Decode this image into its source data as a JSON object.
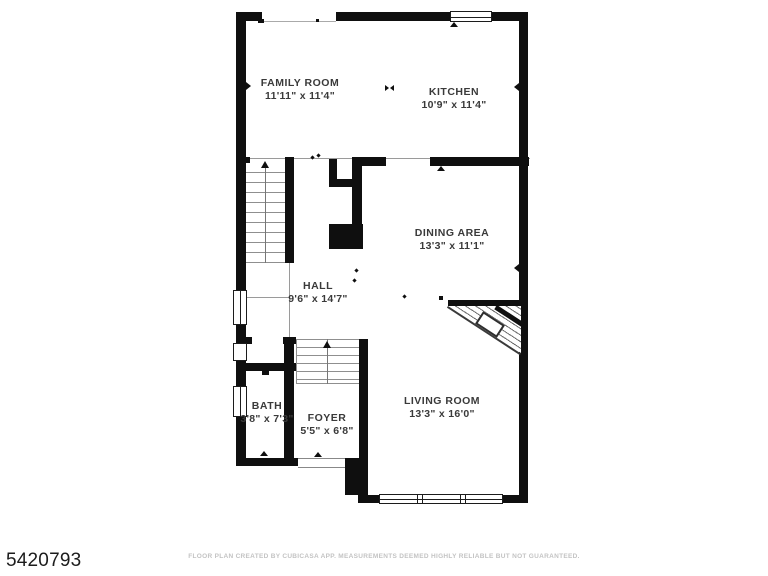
{
  "page": {
    "type": "real-estate floor plan"
  },
  "floor_plan": {
    "rooms": [
      {
        "id": "family-room",
        "name": "FAMILY ROOM",
        "dimensions": "11'11\" x 11'4\""
      },
      {
        "id": "kitchen",
        "name": "KITCHEN",
        "dimensions": "10'9\" x 11'4\""
      },
      {
        "id": "dining-area",
        "name": "DINING AREA",
        "dimensions": "13'3\" x 11'1\""
      },
      {
        "id": "hall",
        "name": "HALL",
        "dimensions": "9'6\" x 14'7\""
      },
      {
        "id": "bath",
        "name": "BATH",
        "dimensions": "3'8\" x 7'3\""
      },
      {
        "id": "foyer",
        "name": "FOYER",
        "dimensions": "5'5\" x 6'8\""
      },
      {
        "id": "living-room",
        "name": "LIVING ROOM",
        "dimensions": "13'3\" x 16'0\""
      }
    ],
    "colors": {
      "wall": "#0f0f0f",
      "thin_line": "#9a9a9a",
      "label_text": "#3a3a3a",
      "id_text": "#1c1c1c",
      "disclaimer_text": "#c3c3c3"
    }
  },
  "footer": {
    "listing_id": "5420793",
    "disclaimer": "FLOOR PLAN CREATED BY CUBICASA APP. MEASUREMENTS DEEMED HIGHLY RELIABLE BUT NOT GUARANTEED."
  }
}
